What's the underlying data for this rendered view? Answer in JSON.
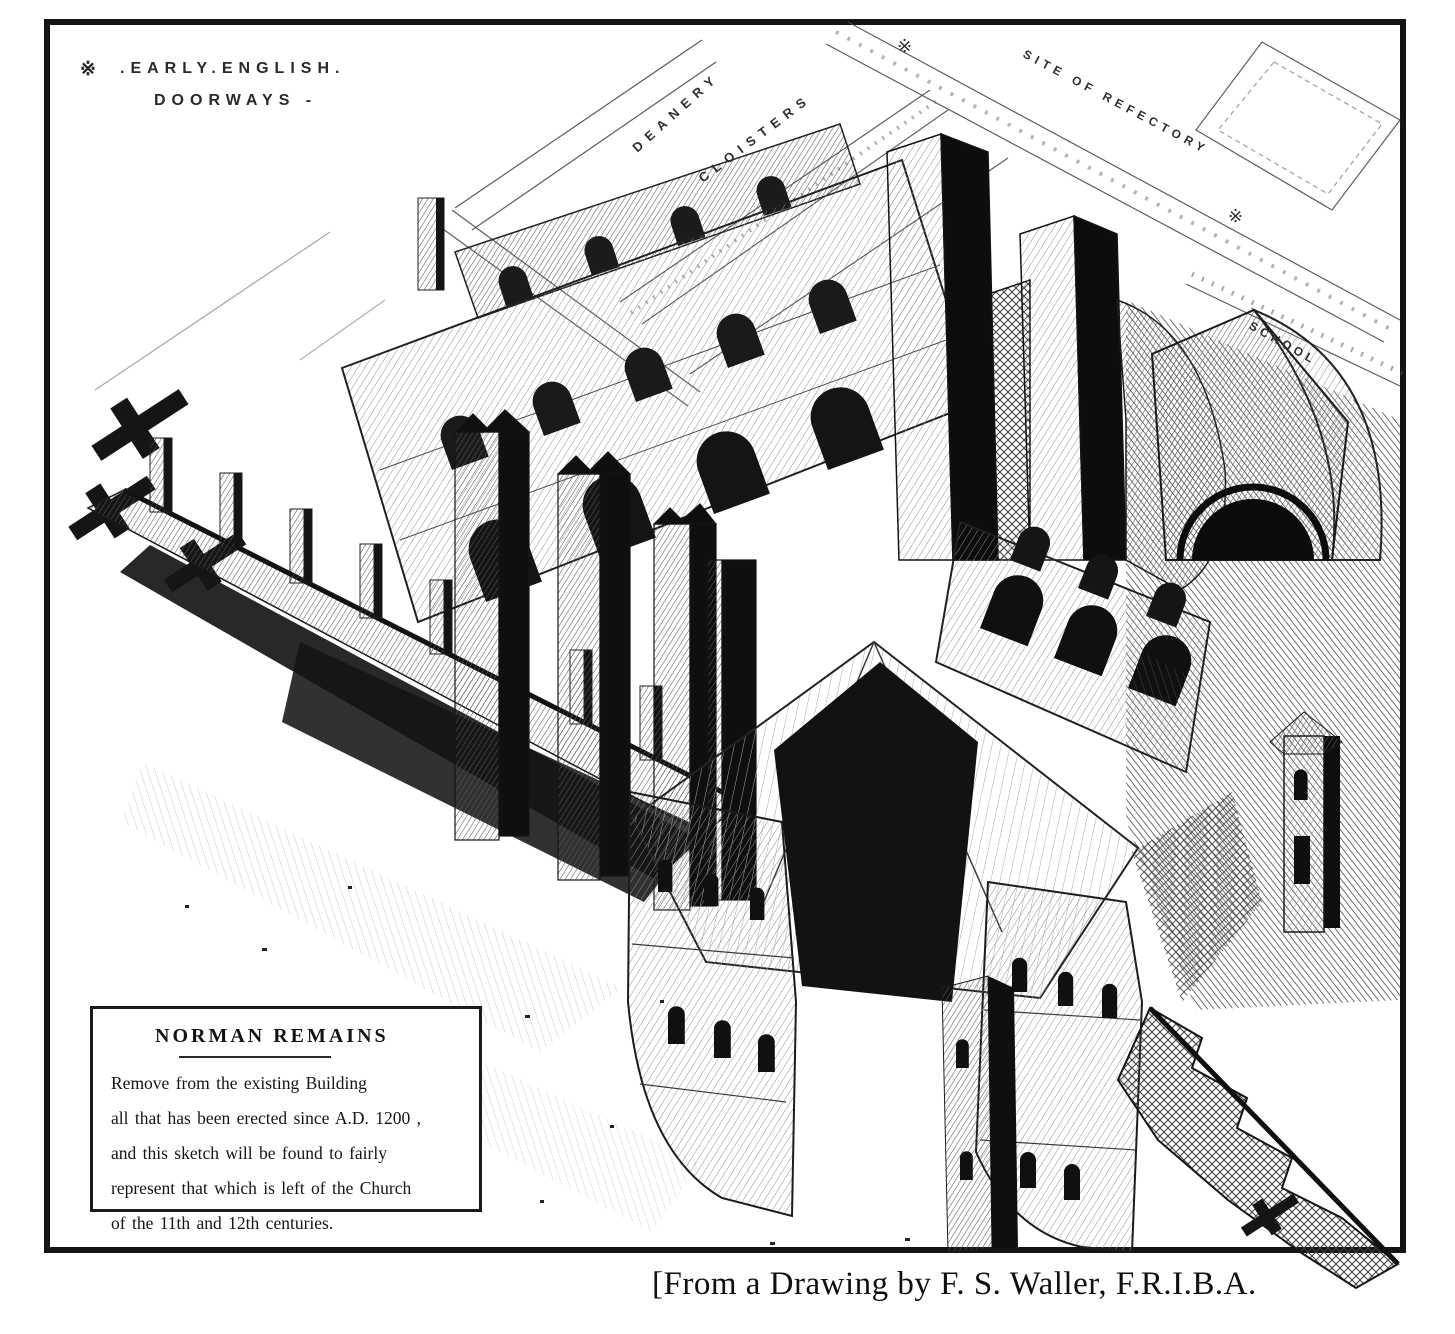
{
  "colors": {
    "ink": "#161616",
    "paper": "#ffffff"
  },
  "doorways_note": {
    "marker": "※",
    "line1": ".EARLY.ENGLISH.",
    "line2": "DOORWAYS -"
  },
  "plan_labels": {
    "deanery": "DEANERY",
    "cloisters": "CLOISTERS",
    "site_of_refectory": "SITE OF REFECTORY",
    "school": "SCHOOL"
  },
  "legend": {
    "title": "NORMAN REMAINS",
    "lines": [
      "Remove from the existing Building",
      "all that has been erected since A.D. 1200 ,",
      "and this sketch will be found to fairly",
      "represent that which is left of the Church",
      "of the 11th and 12th centuries."
    ]
  },
  "caption": "[From a Drawing by F. S. Waller, F.R.I.B.A."
}
